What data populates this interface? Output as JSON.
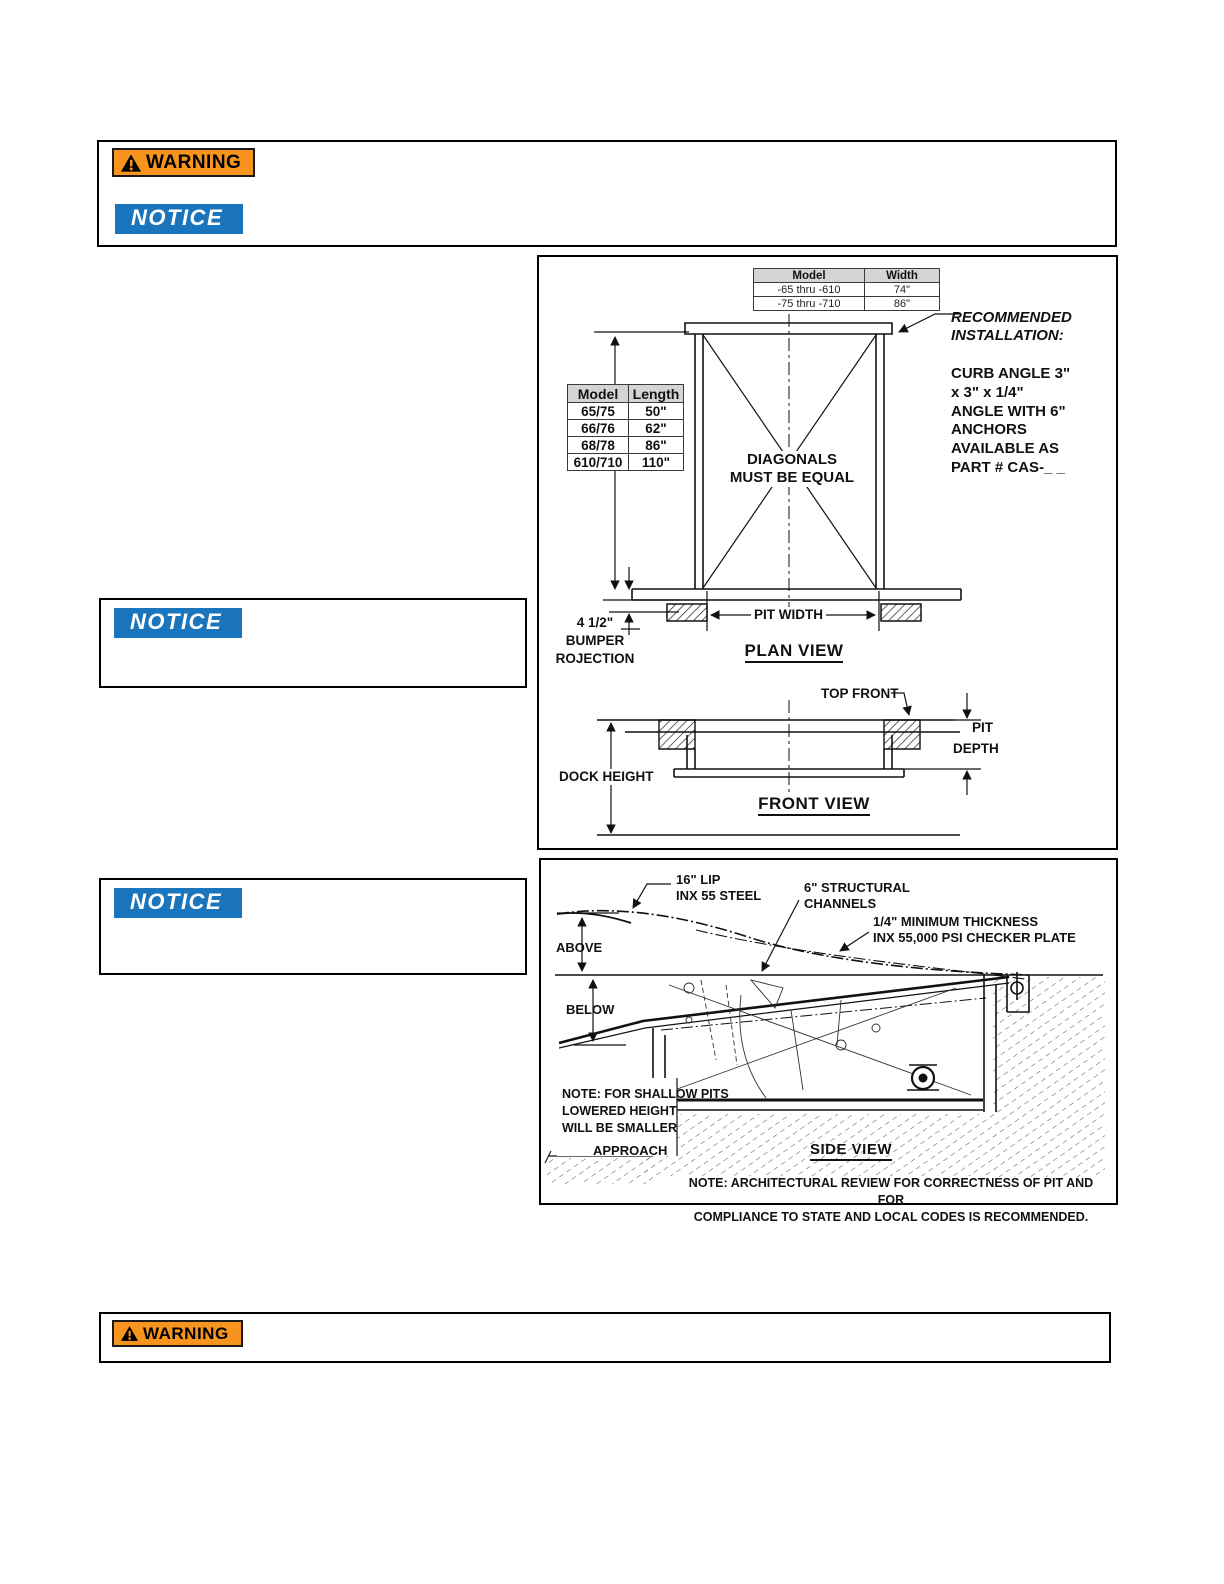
{
  "colors": {
    "warning_orange": "#F7941D",
    "notice_blue": "#1B75BC",
    "line_black": "#111111"
  },
  "top_box": {
    "warning_label": "WARNING",
    "notice_label": "NOTICE"
  },
  "notice_box_1": {
    "label": "NOTICE"
  },
  "notice_box_2": {
    "label": "NOTICE"
  },
  "bottom_box": {
    "warning_label": "WARNING"
  },
  "plan": {
    "width_table": {
      "headers": [
        "Model",
        "Width"
      ],
      "rows": [
        [
          "-65 thru -610",
          "74\""
        ],
        [
          "-75 thru -710",
          "86\""
        ]
      ]
    },
    "length_table": {
      "headers": [
        "Model",
        "Length"
      ],
      "rows": [
        [
          "65/75",
          "50\""
        ],
        [
          "66/76",
          "62\""
        ],
        [
          "68/78",
          "86\""
        ],
        [
          "610/710",
          "110\""
        ]
      ]
    },
    "rec_heading": [
      "RECOMMENDED",
      "INSTALLATION:"
    ],
    "rec_body": [
      "CURB ANGLE 3\"",
      "x 3\" x 1/4\"",
      "ANGLE WITH 6\"",
      "ANCHORS",
      "AVAILABLE AS",
      "PART # CAS-_ _"
    ],
    "diagonals": [
      "DIAGONALS",
      "MUST BE EQUAL"
    ],
    "pit_width": "PIT WIDTH",
    "plan_title": "PLAN VIEW",
    "bumper": [
      "4 1/2\"",
      "BUMPER",
      "ROJECTION"
    ],
    "top_front": "TOP FRONT",
    "pit_depth": [
      "PIT",
      "DEPTH"
    ],
    "dock_height": "DOCK HEIGHT",
    "front_title": "FRONT VIEW"
  },
  "side": {
    "lip": [
      "16\" LIP",
      "INX 55 STEEL"
    ],
    "channels": [
      "6\" STRUCTURAL",
      "CHANNELS"
    ],
    "plate": [
      "1/4\" MINIMUM THICKNESS",
      "INX 55,000 PSI CHECKER PLATE"
    ],
    "above": "ABOVE",
    "below": "BELOW",
    "shallow_note": [
      "NOTE: FOR SHALLOW PITS",
      "LOWERED HEIGHT",
      "WILL BE SMALLER"
    ],
    "approach": "APPROACH",
    "side_title": "SIDE VIEW",
    "bottom_note": [
      "NOTE: ARCHITECTURAL REVIEW FOR CORRECTNESS OF PIT AND FOR",
      "COMPLIANCE TO STATE AND LOCAL CODES IS RECOMMENDED."
    ]
  }
}
